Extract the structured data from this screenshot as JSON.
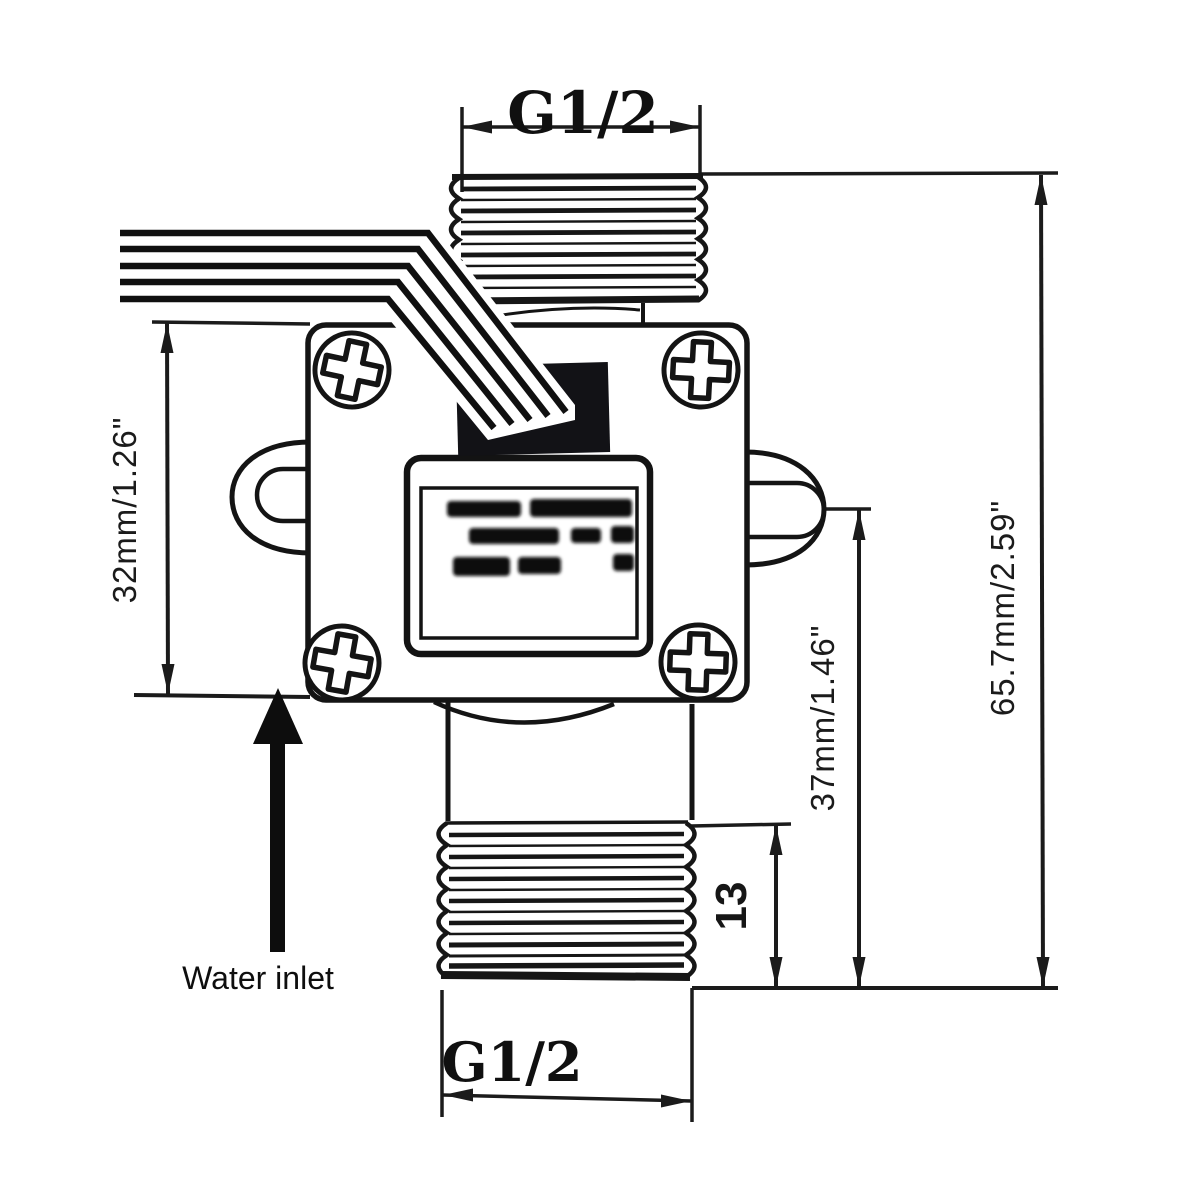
{
  "labels": {
    "top_port": "G1/2",
    "bottom_port": "G1/2",
    "water_inlet": "Water inlet"
  },
  "dimensions": {
    "body_height": "32mm/1.26\"",
    "port_center_to_base": "37mm/1.46\"",
    "bottom_thread_length": "13",
    "overall_height": "65.7mm/2.59\""
  },
  "icons": {
    "screw": "phillips-screw-icon",
    "inlet_arrow": "up-arrow-icon"
  },
  "colors": {
    "line": "#1b1b1b",
    "background": "#ffffff",
    "connector_block": "#121216"
  }
}
